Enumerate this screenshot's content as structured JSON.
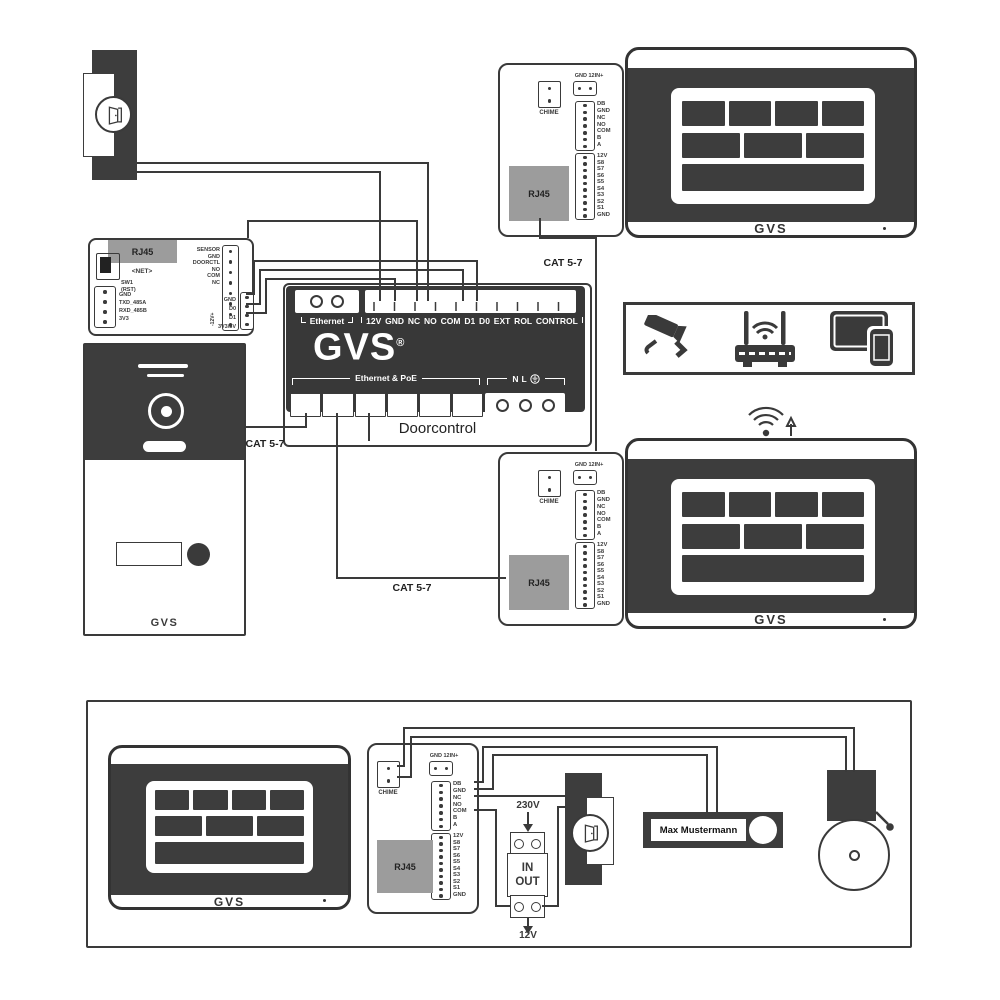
{
  "brand": {
    "logo": "GVS",
    "reg": "®"
  },
  "cables": {
    "cat57": "CAT 5-7"
  },
  "doorcontrol": {
    "name": "Doorcontrol",
    "ethernet": "Ethernet",
    "terminals": "12V GND NC NO COM D1 D0 EXT ROL CONTROL",
    "poe": "Ethernet & PoE",
    "n": "N",
    "l": "L"
  },
  "gateway": {
    "rj45": "RJ45",
    "net": "<NET>",
    "sw": "SW1",
    "rst": "(RST)",
    "left_pins": [
      "GND",
      "TXD_485A",
      "RXD_485B",
      "3V3"
    ],
    "top_pins": [
      "SENSOR",
      "GND",
      "DOORCTL",
      "NO",
      "COM",
      "NC"
    ],
    "data_pins": [
      "GND",
      "D0",
      "D1",
      "3V3/5V"
    ],
    "bus": "-12V+"
  },
  "module": {
    "chime": "CHIME",
    "power": "GND 12IN+",
    "rj45": "RJ45",
    "bus_pins": [
      "DB",
      "GND",
      "NC",
      "NO",
      "COM",
      "B",
      "A"
    ],
    "s_pins": [
      "12V",
      "S8",
      "S7",
      "S6",
      "S5",
      "S4",
      "S3",
      "S2",
      "S1",
      "GND"
    ]
  },
  "supply": {
    "input": "230V",
    "in": "IN",
    "out": "OUT",
    "output": "12V"
  },
  "doorbell": {
    "name": "Max Mustermann"
  }
}
